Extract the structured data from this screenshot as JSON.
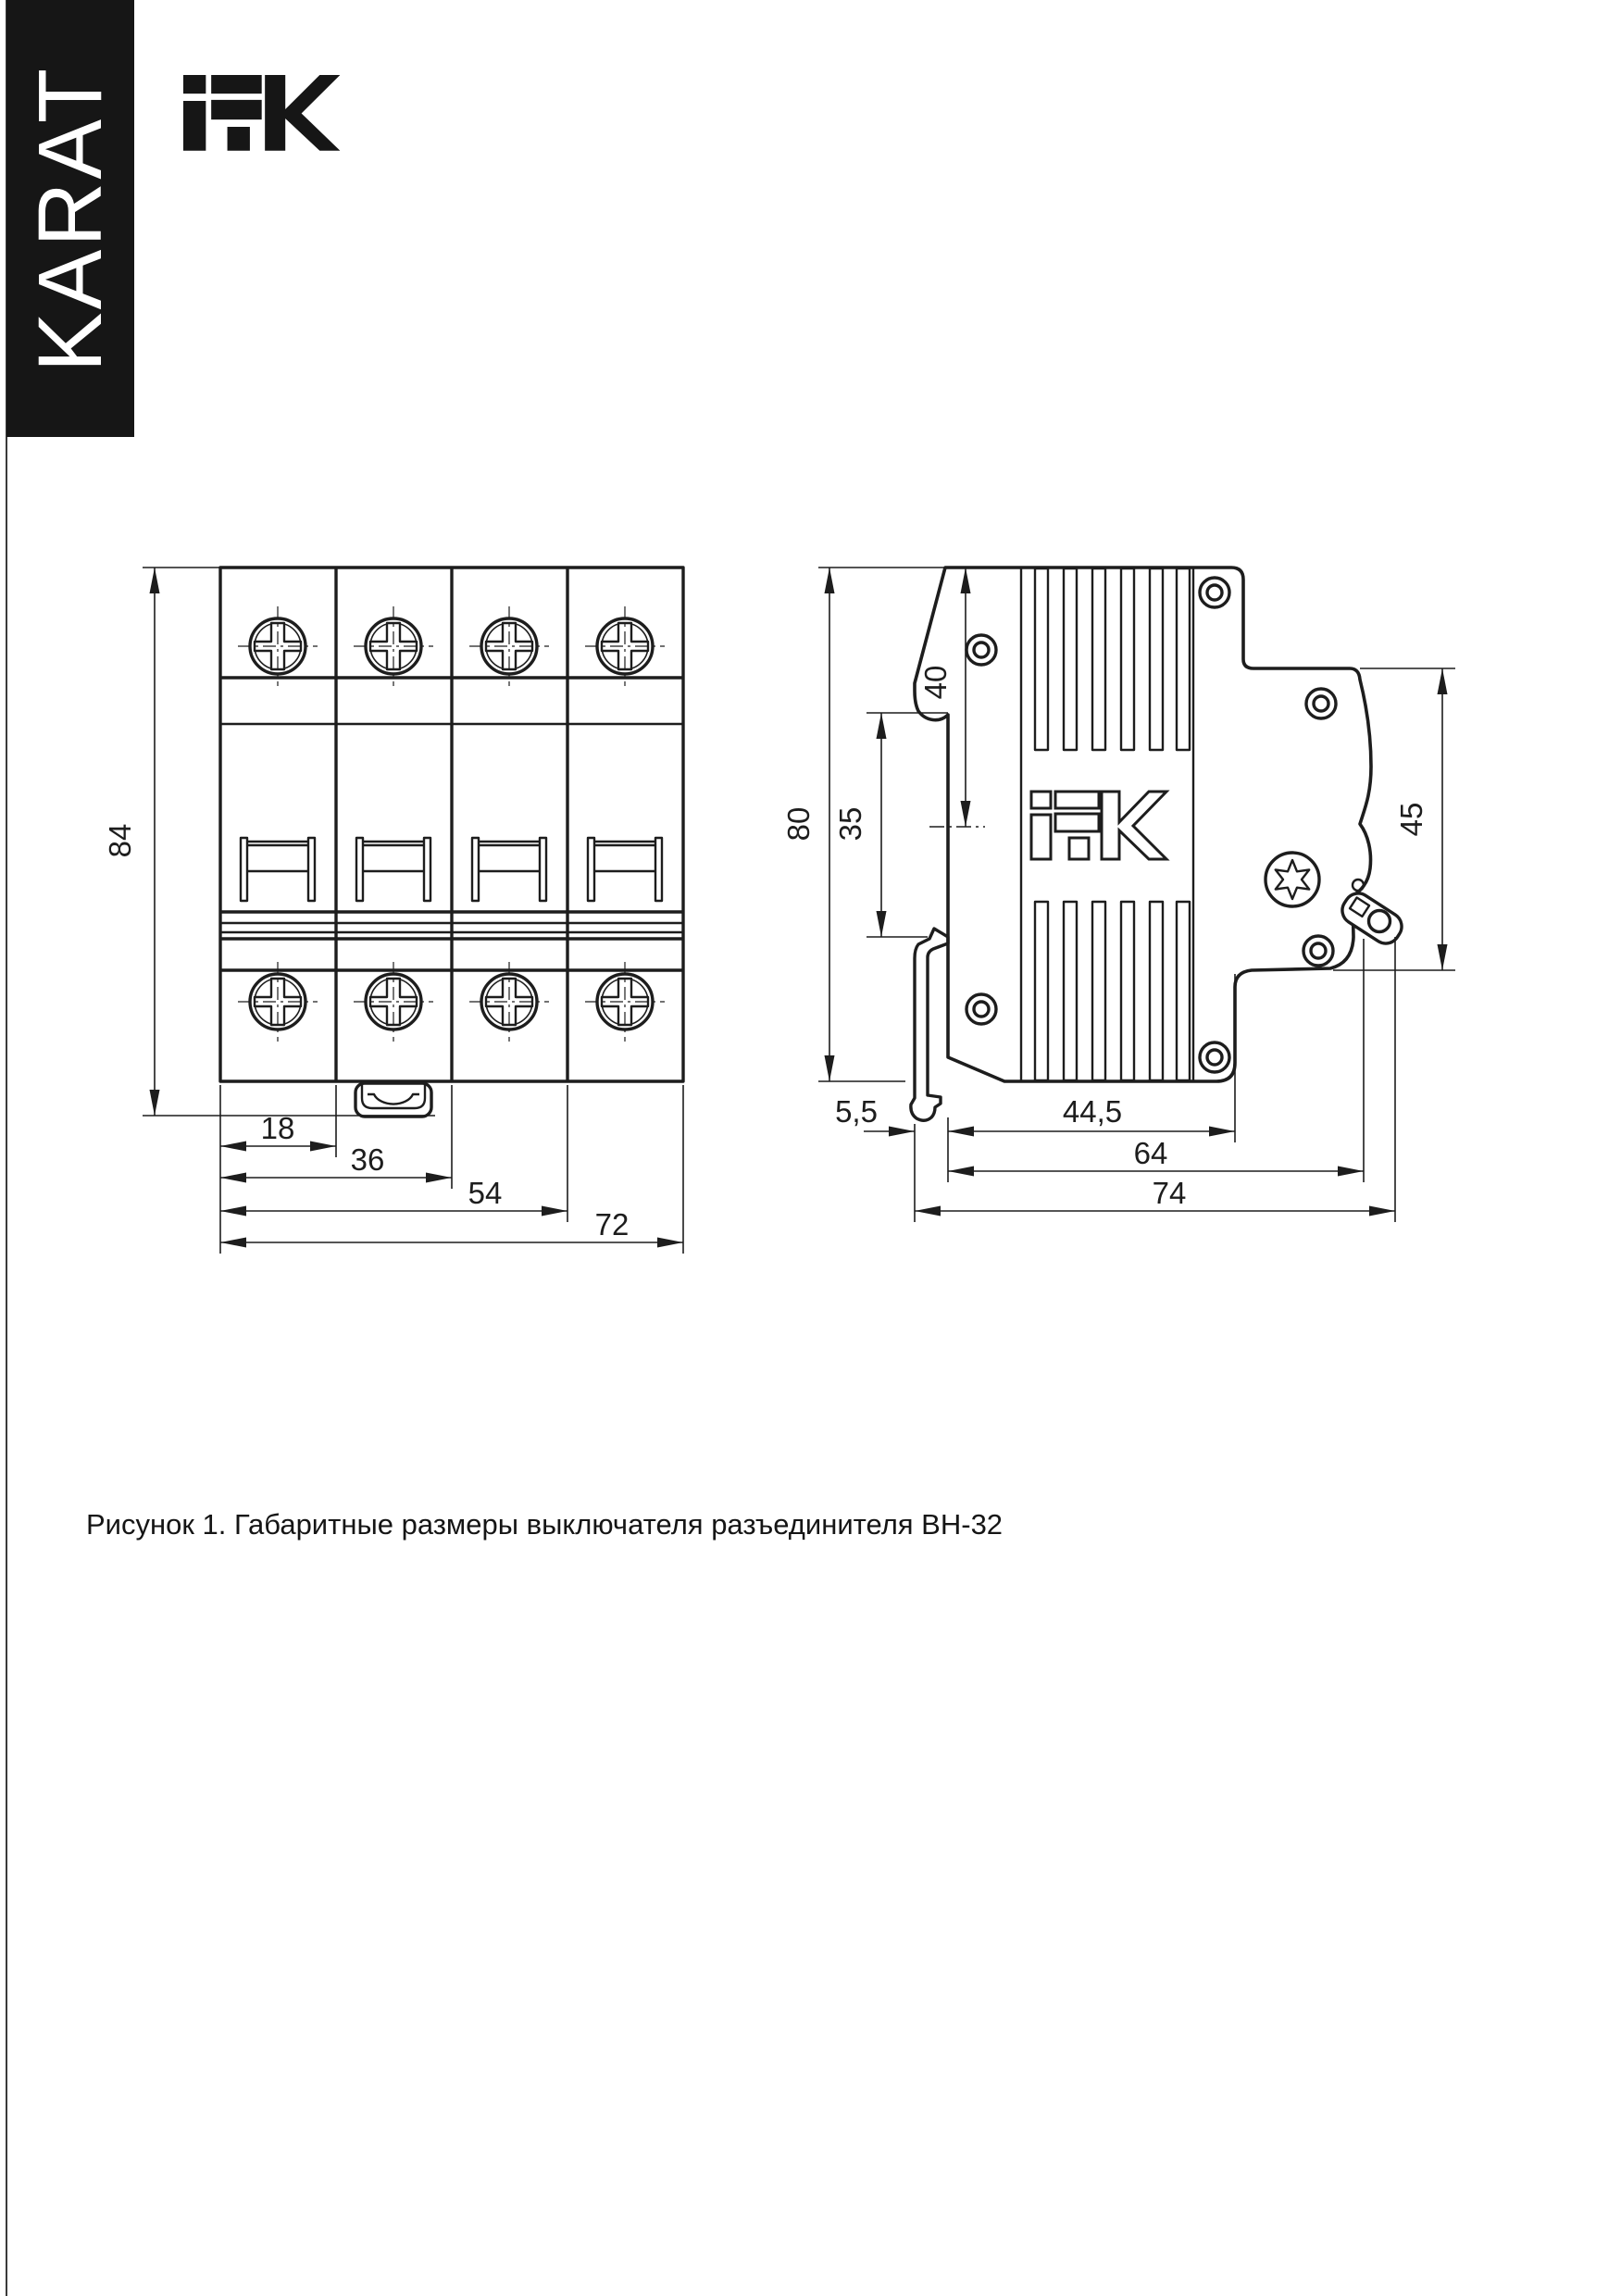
{
  "page": {
    "background": "#ffffff",
    "ink_color": "#1d1d1d"
  },
  "side_banner": {
    "label": "KARAT",
    "background": "#161616",
    "text_color": "#ffffff"
  },
  "header": {
    "brand_logo": "IEK"
  },
  "figure": {
    "caption": "Рисунок 1. Габаритные размеры выключателя разъединителя ВН-32",
    "front_view": {
      "description": "front view of 4-pole switch disconnector",
      "dims": {
        "height_mm": "84",
        "module_width_mm": "18",
        "two_modules_mm": "36",
        "three_modules_mm": "54",
        "total_width_mm": "72"
      }
    },
    "side_view": {
      "description": "side view with DIN rail mount",
      "brand_emboss": "IEK",
      "dims": {
        "total_height_mm": "80",
        "din_recess_mm": "35",
        "top_to_rail_center_mm": "40",
        "front_height_mm": "45",
        "rear_depth_mm": "5,5",
        "rail_to_front_mm": "44,5",
        "depth_to_clip_mm": "64",
        "total_depth_mm": "74"
      }
    }
  }
}
